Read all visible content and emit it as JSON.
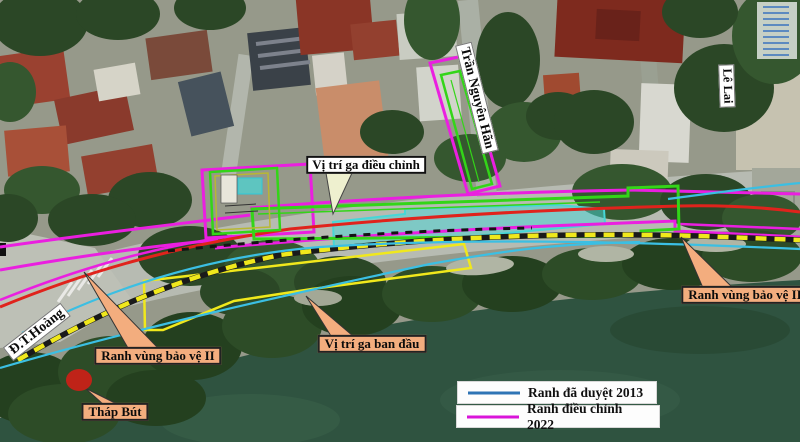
{
  "map_labels": {
    "street_dt_hoang": "Đ.T.Hoàng",
    "street_tran_nguyen_han": "Trần Nguyên Hãn",
    "street_le_lai": "Lê Lai",
    "station_adjusted": "Vị trí ga điều chỉnh",
    "station_initial": "Vị trí ga ban đầu",
    "protection_zone_left": "Ranh vùng bảo vệ II",
    "protection_zone_right": "Ranh vùng bảo vệ II",
    "thap_but": "Tháp Bút"
  },
  "legend": {
    "items": [
      {
        "label": "Ranh đã duyệt 2013",
        "color": "#2e74b5"
      },
      {
        "label": "Ranh điều chỉnh 2022",
        "color": "#d913d9"
      }
    ]
  },
  "overlay_colors": {
    "boundary_2013_cyan": "#3bbfe3",
    "boundary_2022_magenta": "#ea1fe0",
    "route_red": "#e0231c",
    "station_adjusted_green": "#33d518",
    "station_teal_fill": "#46d7d7",
    "station_initial_yellow": "#f0e81c",
    "callout_fill_peach": "#f3ad7e",
    "marker_red_dot": "#bf2318"
  }
}
